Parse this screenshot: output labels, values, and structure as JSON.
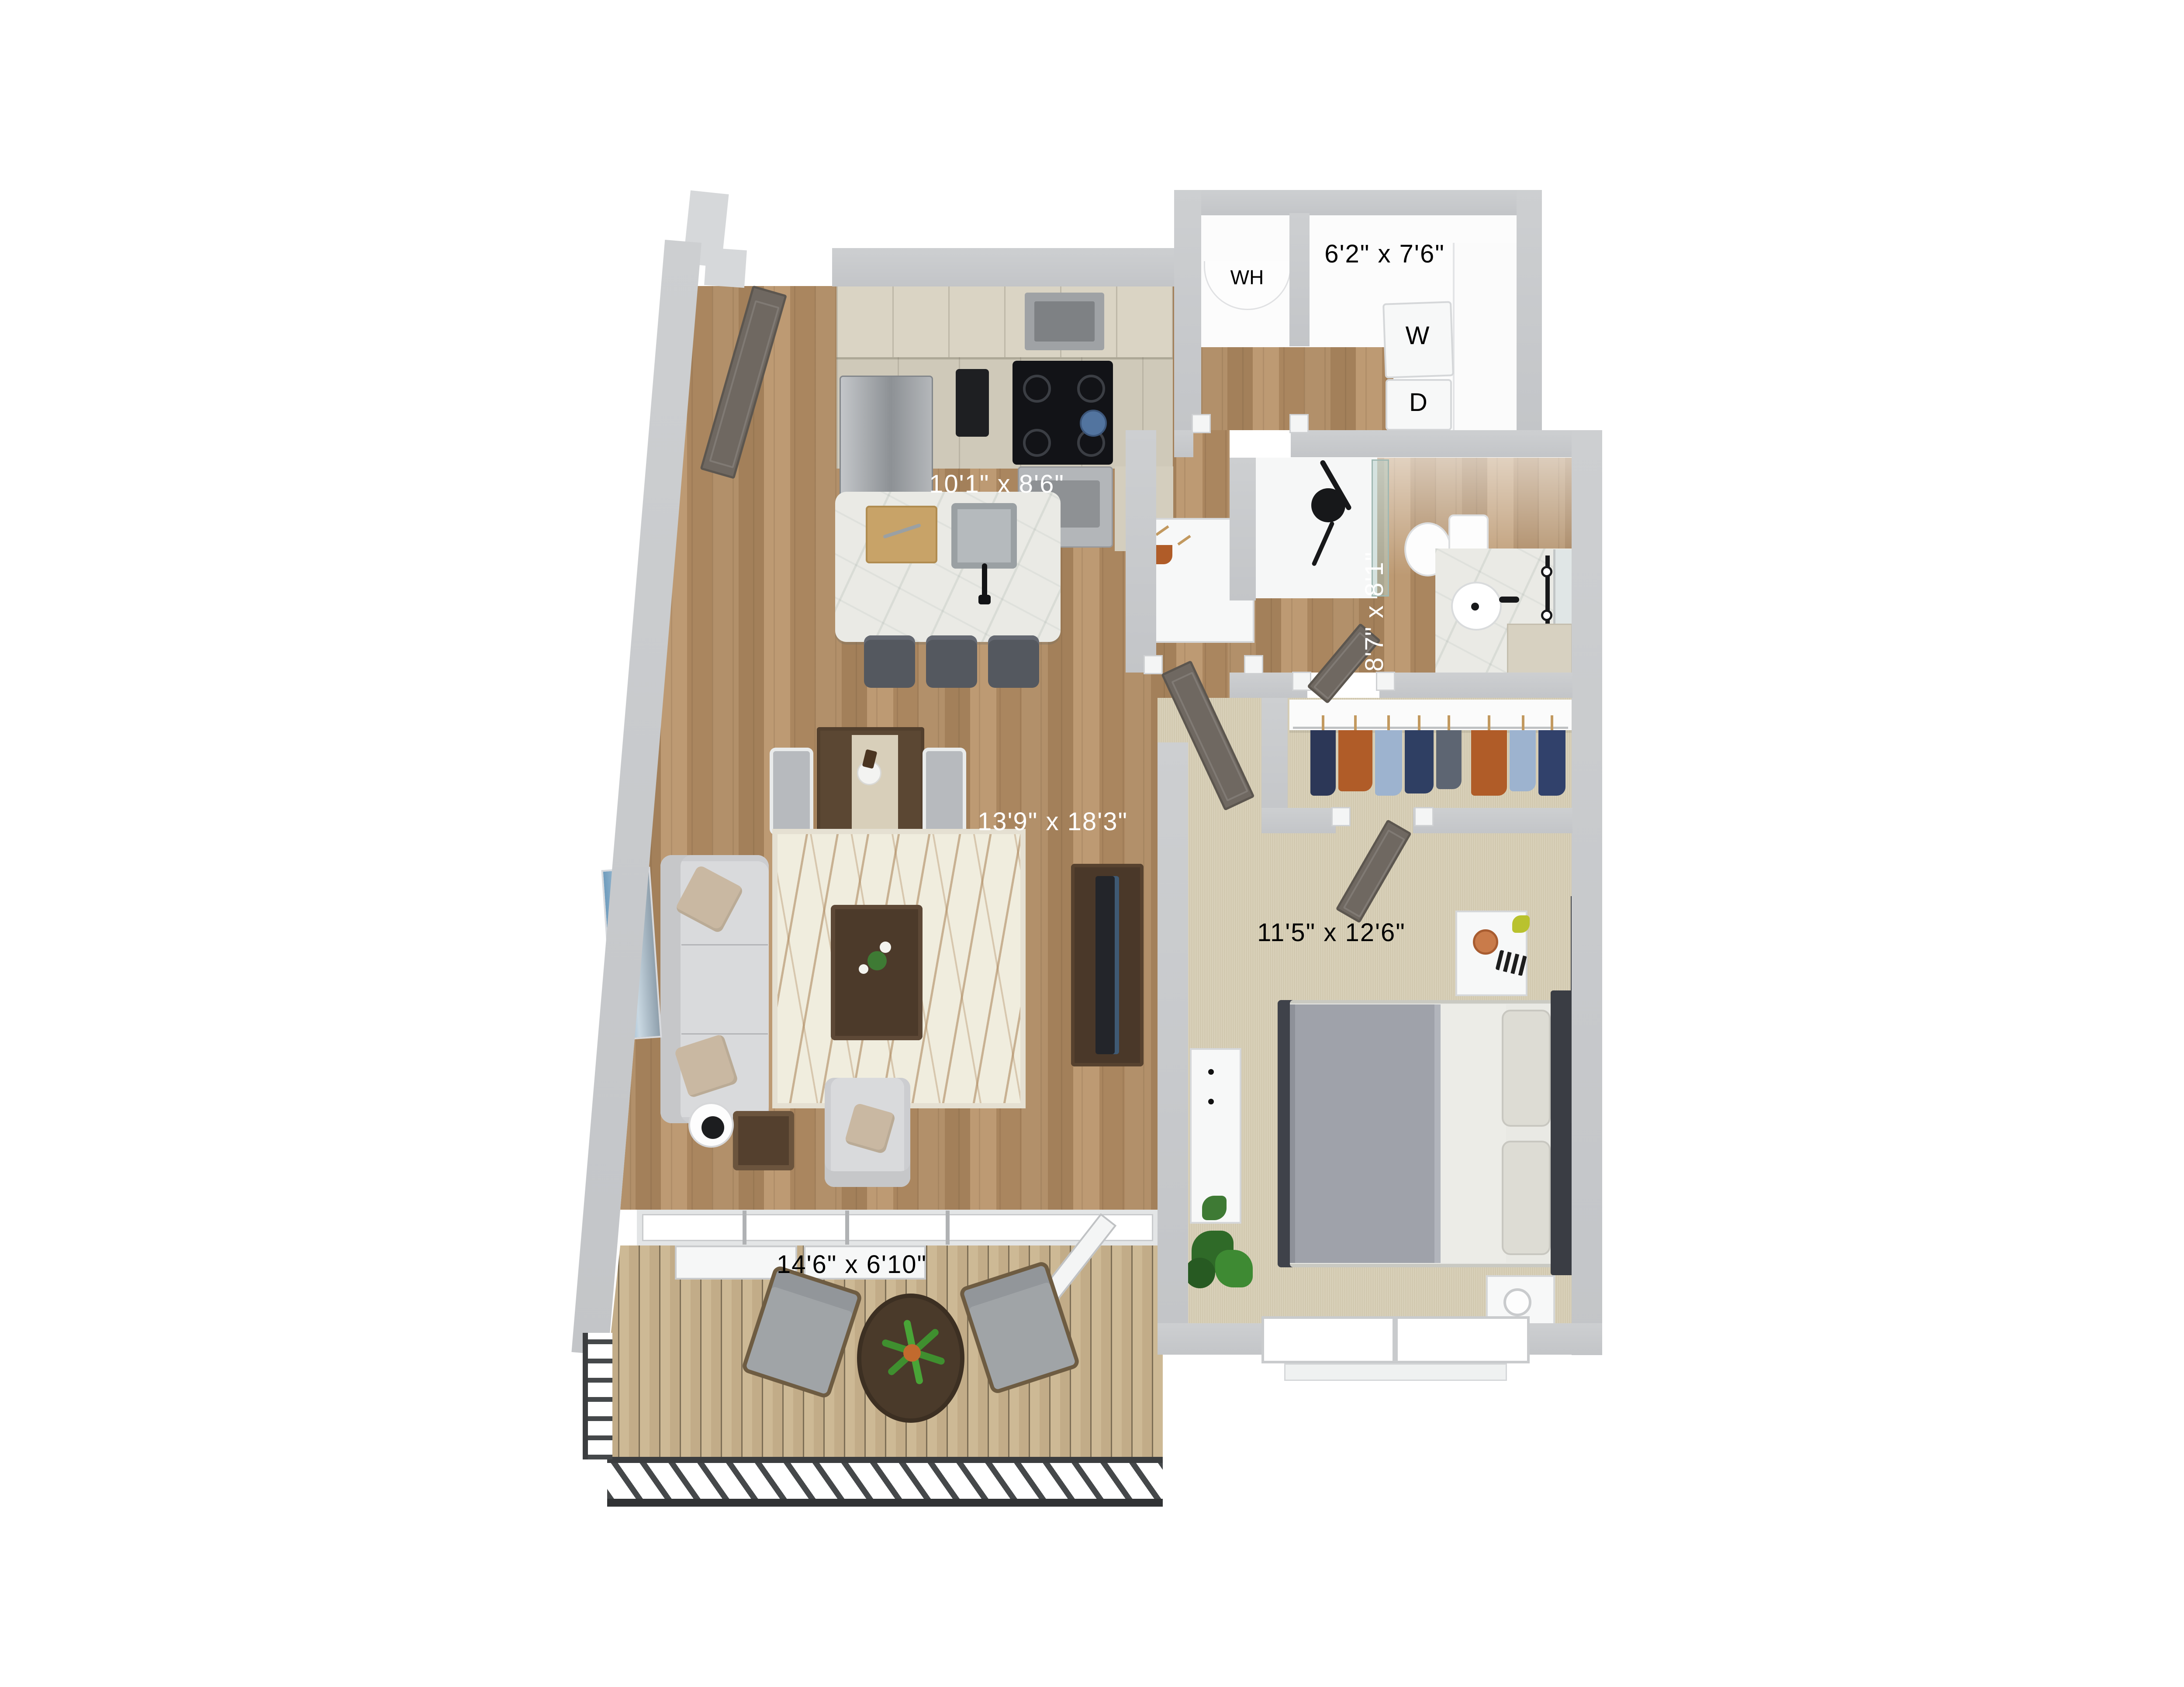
{
  "labels": {
    "laundry_dim": "6'2\" x 7'6\"",
    "kitchen_dim": "10'1\" x 8'6\"",
    "bathroom_dim": "8'7\" x 8'1\"",
    "living_dim": "13'9\" x 18'3\"",
    "bedroom_dim": "11'5\" x 12'6\"",
    "balcony_dim": "14'6\" x 6'10\"",
    "water_heater": "WH",
    "washer": "W",
    "dryer": "D"
  },
  "palette": {
    "wall": "#c9cbce",
    "wood_floor": "#ad8a61",
    "deck_floor": "#c9b490",
    "carpet": "#d6cdb3",
    "kitchen_counter": "#d9d3c3",
    "island_top": "#eaeae5",
    "sofa": "#d9dadc",
    "rug": "#f0edde",
    "dark_wood_furniture": "#4e3b2b",
    "bed_duvet": "#9fa2aa",
    "railing": "#3b3d3f",
    "door": "#6f6861",
    "dimension_text_light": "#ffffff",
    "dimension_text_dark": "#000000",
    "accent_garment_orange": "#b05c28",
    "accent_garment_navy": "#2c3757",
    "artwork_blue": "#7fa7c4"
  }
}
